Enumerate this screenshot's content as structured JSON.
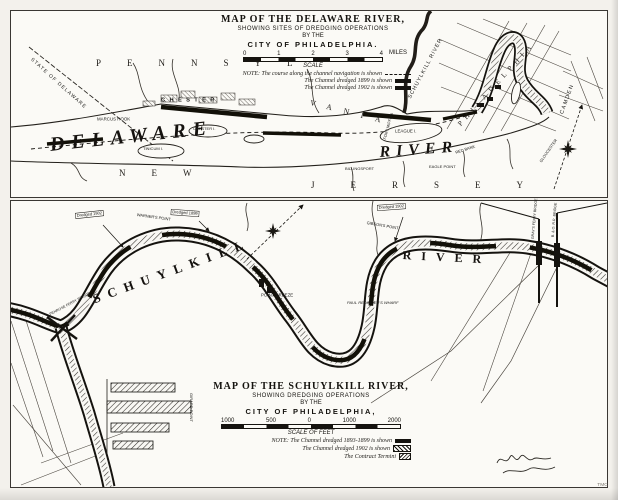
{
  "sheet": {
    "corner_mark": "TMC"
  },
  "delaware_map": {
    "title": "MAP OF THE DELAWARE RIVER,",
    "subtitle": "SHOWING SITES OF DREDGING OPERATIONS",
    "byline": "BY THE",
    "city_line": "CITY OF PHILADELPHIA.",
    "scale": {
      "ticks": [
        "0",
        "1",
        "2",
        "3",
        "4"
      ],
      "unit": "MILES",
      "caption": "SCALE"
    },
    "notes": [
      {
        "text": "NOTE: The course along the channel navigation is shown"
      },
      {
        "text": "The Channel dredged 1899 is shown"
      },
      {
        "text": "The Channel dredged 1902 is shown"
      }
    ],
    "labels": {
      "state_boundary": "STATE OF DELAWARE",
      "pennsylvania_1": "PENNSYL",
      "pennsylvania_2": "VANIA",
      "chester": "CHESTER",
      "marcus_hook": "MARCUS HOOK",
      "delaware": "DELAWARE",
      "river": "RIVER",
      "new_jersey_1": "NEW",
      "new_jersey_2": "JERSEY",
      "tinicum_island": "TINICUM I.",
      "chester_island": "CHESTER I.",
      "league_island": "LEAGUE I.",
      "fort_mifflin": "FORT MIFFLIN",
      "billingsport": "BILLINGSPORT",
      "red_bank": "RED BANK",
      "eagle_point": "EAGLE POINT",
      "gloucester": "GLOUCESTER",
      "schuylkill_river": "SCHUYLKILL RIVER",
      "philadelphia": "PHILADELPHIA",
      "camden": "CAMDEN"
    }
  },
  "schuylkill_map": {
    "title": "MAP OF THE SCHUYLKILL RIVER,",
    "subtitle": "SHOWING DREDGING OPERATIONS",
    "byline": "BY THE",
    "city_line": "CITY OF PHILADELPHIA,",
    "scale": {
      "ticks": [
        "1000",
        "500",
        "0",
        "1000",
        "2000"
      ],
      "caption": "SCALE OF FEET"
    },
    "notes": [
      {
        "text": "NOTE: The Channel dredged 1893-1899 is shown"
      },
      {
        "text": "The Channel dredged 1902 is shown"
      },
      {
        "text": "The Contract Termini"
      }
    ],
    "labels": {
      "schuylkill": "SCHUYLKILL",
      "river": "RIVER",
      "warners_point": "WARNER'S POINT",
      "point_breeze": "POINT BREEZE",
      "redingers_wharf": "PAUL REDINGER'S WHARF",
      "gibsons_point": "GIBSON'S POINT",
      "girard_point": "GIRARD POINT",
      "penrose_ferry": "PENROSE FERRY BRIDGE",
      "grays_ferry": "GRAY'S FERRY BRIDGE",
      "bo_railroad": "B. & O. R.R. BRIDGE"
    },
    "callouts": [
      "Dredged 1902",
      "Dredged 1899",
      "Dredged 1902"
    ]
  }
}
